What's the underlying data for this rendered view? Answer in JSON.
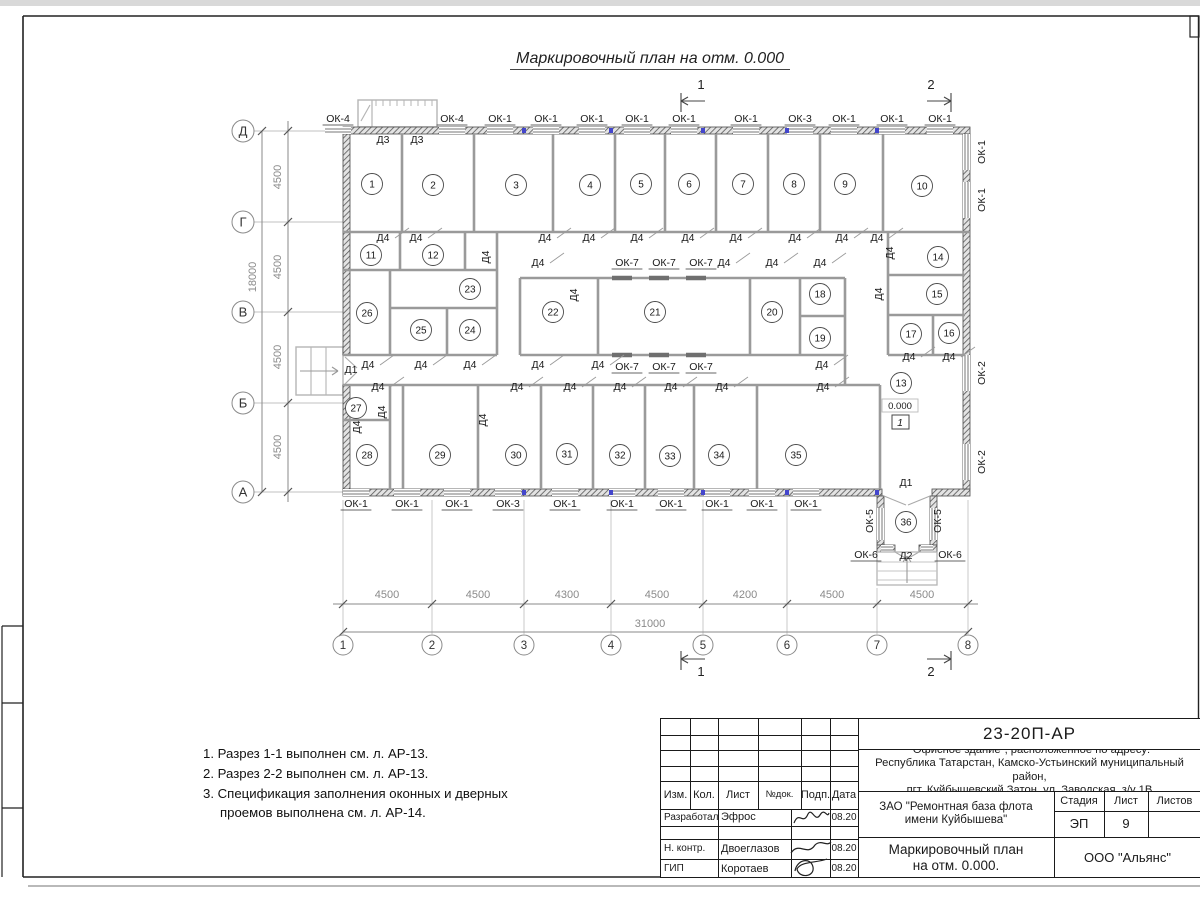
{
  "sheet": {
    "plan_title": "Маркировочный план на отм. 0.000"
  },
  "notes": {
    "items": [
      "1. Разрез 1-1 выполнен см. л. АР-13.",
      "2. Разрез 2-2 выполнен см. л. АР-13.",
      "3. Спецификация заполнения оконных и дверных проемов выполнена см. л. АР-14."
    ]
  },
  "plan": {
    "axis_cols": [
      {
        "label": "1",
        "x": 343
      },
      {
        "label": "2",
        "x": 432
      },
      {
        "label": "3",
        "x": 524
      },
      {
        "label": "4",
        "x": 611
      },
      {
        "label": "5",
        "x": 703
      },
      {
        "label": "6",
        "x": 787
      },
      {
        "label": "7",
        "x": 877
      },
      {
        "label": "8",
        "x": 968
      }
    ],
    "axis_rows": [
      {
        "label": "Д",
        "y": 131
      },
      {
        "label": "Г",
        "y": 222
      },
      {
        "label": "В",
        "y": 312
      },
      {
        "label": "Б",
        "y": 403
      },
      {
        "label": "А",
        "y": 492
      }
    ],
    "dims_bottom": {
      "segments": [
        {
          "text": "4500",
          "x": 387
        },
        {
          "text": "4500",
          "x": 478
        },
        {
          "text": "4300",
          "x": 567
        },
        {
          "text": "4500",
          "x": 657
        },
        {
          "text": "4200",
          "x": 745
        },
        {
          "text": "4500",
          "x": 832
        },
        {
          "text": "4500",
          "x": 922
        }
      ],
      "total": {
        "text": "31000",
        "x": 650
      }
    },
    "dims_left": {
      "segments": [
        {
          "text": "4500",
          "y": 177
        },
        {
          "text": "4500",
          "y": 267
        },
        {
          "text": "4500",
          "y": 357
        },
        {
          "text": "4500",
          "y": 447
        }
      ],
      "total": {
        "text": "18000",
        "y": 277
      }
    },
    "rooms": [
      {
        "n": "1",
        "x": 372,
        "y": 184
      },
      {
        "n": "2",
        "x": 433,
        "y": 185
      },
      {
        "n": "3",
        "x": 516,
        "y": 185
      },
      {
        "n": "4",
        "x": 590,
        "y": 185
      },
      {
        "n": "5",
        "x": 641,
        "y": 184
      },
      {
        "n": "6",
        "x": 689,
        "y": 184
      },
      {
        "n": "7",
        "x": 743,
        "y": 184
      },
      {
        "n": "8",
        "x": 794,
        "y": 184
      },
      {
        "n": "9",
        "x": 845,
        "y": 184
      },
      {
        "n": "10",
        "x": 922,
        "y": 186
      },
      {
        "n": "11",
        "x": 371,
        "y": 255
      },
      {
        "n": "12",
        "x": 433,
        "y": 255
      },
      {
        "n": "13",
        "x": 901,
        "y": 383
      },
      {
        "n": "14",
        "x": 938,
        "y": 257
      },
      {
        "n": "15",
        "x": 937,
        "y": 294
      },
      {
        "n": "16",
        "x": 949,
        "y": 333
      },
      {
        "n": "17",
        "x": 911,
        "y": 334
      },
      {
        "n": "18",
        "x": 820,
        "y": 294
      },
      {
        "n": "19",
        "x": 820,
        "y": 338
      },
      {
        "n": "20",
        "x": 772,
        "y": 312
      },
      {
        "n": "21",
        "x": 655,
        "y": 312
      },
      {
        "n": "22",
        "x": 553,
        "y": 312
      },
      {
        "n": "23",
        "x": 470,
        "y": 289
      },
      {
        "n": "24",
        "x": 470,
        "y": 330
      },
      {
        "n": "25",
        "x": 421,
        "y": 330
      },
      {
        "n": "26",
        "x": 367,
        "y": 313
      },
      {
        "n": "27",
        "x": 356,
        "y": 408
      },
      {
        "n": "28",
        "x": 367,
        "y": 455
      },
      {
        "n": "29",
        "x": 440,
        "y": 455
      },
      {
        "n": "30",
        "x": 516,
        "y": 455
      },
      {
        "n": "31",
        "x": 567,
        "y": 454
      },
      {
        "n": "32",
        "x": 620,
        "y": 455
      },
      {
        "n": "33",
        "x": 670,
        "y": 456
      },
      {
        "n": "34",
        "x": 719,
        "y": 455
      },
      {
        "n": "35",
        "x": 796,
        "y": 455
      },
      {
        "n": "36",
        "x": 906,
        "y": 522
      }
    ],
    "marks": [
      {
        "t": "ОК-4",
        "x": 338,
        "y": 122,
        "u": 1
      },
      {
        "t": "ОК-4",
        "x": 452,
        "y": 122,
        "u": 1
      },
      {
        "t": "ОК-1",
        "x": 500,
        "y": 122,
        "u": 1
      },
      {
        "t": "ОК-1",
        "x": 546,
        "y": 122,
        "u": 1
      },
      {
        "t": "ОК-1",
        "x": 592,
        "y": 122,
        "u": 1
      },
      {
        "t": "ОК-1",
        "x": 637,
        "y": 122,
        "u": 1
      },
      {
        "t": "ОК-1",
        "x": 684,
        "y": 122,
        "u": 1
      },
      {
        "t": "ОК-1",
        "x": 746,
        "y": 122,
        "u": 1
      },
      {
        "t": "ОК-3",
        "x": 800,
        "y": 122,
        "u": 1
      },
      {
        "t": "ОК-1",
        "x": 844,
        "y": 122,
        "u": 1
      },
      {
        "t": "ОК-1",
        "x": 892,
        "y": 122,
        "u": 1
      },
      {
        "t": "ОК-1",
        "x": 940,
        "y": 122,
        "u": 1
      },
      {
        "t": "Д3",
        "x": 383,
        "y": 143
      },
      {
        "t": "Д3",
        "x": 417,
        "y": 143
      },
      {
        "t": "Д4",
        "x": 383,
        "y": 241,
        "d": 1
      },
      {
        "t": "Д4",
        "x": 416,
        "y": 241,
        "d": 1
      },
      {
        "t": "Д4",
        "x": 545,
        "y": 241,
        "d": 1
      },
      {
        "t": "Д4",
        "x": 589,
        "y": 241,
        "d": 1
      },
      {
        "t": "Д4",
        "x": 637,
        "y": 241,
        "d": 1
      },
      {
        "t": "Д4",
        "x": 688,
        "y": 241,
        "d": 1
      },
      {
        "t": "Д4",
        "x": 736,
        "y": 241,
        "d": 1
      },
      {
        "t": "Д4",
        "x": 795,
        "y": 241,
        "d": 1
      },
      {
        "t": "Д4",
        "x": 842,
        "y": 241,
        "d": 1
      },
      {
        "t": "Д4",
        "x": 877,
        "y": 241,
        "d": 1
      },
      {
        "t": "Д4",
        "x": 489,
        "y": 257,
        "r": 1
      },
      {
        "t": "Д4",
        "x": 577,
        "y": 295,
        "r": 1
      },
      {
        "t": "Д4",
        "x": 893,
        "y": 253,
        "r": 1
      },
      {
        "t": "Д4",
        "x": 882,
        "y": 294,
        "r": 1
      },
      {
        "t": "Д4",
        "x": 538,
        "y": 266,
        "d": 1
      },
      {
        "t": "Д4",
        "x": 724,
        "y": 266,
        "d": 1
      },
      {
        "t": "Д4",
        "x": 772,
        "y": 266,
        "d": 1
      },
      {
        "t": "Д4",
        "x": 820,
        "y": 266,
        "d": 1
      },
      {
        "t": "ОК-7",
        "x": 627,
        "y": 266,
        "u": 1
      },
      {
        "t": "ОК-7",
        "x": 664,
        "y": 266,
        "u": 1
      },
      {
        "t": "ОК-7",
        "x": 701,
        "y": 266,
        "u": 1
      },
      {
        "t": "Д4",
        "x": 368,
        "y": 368,
        "d": 1
      },
      {
        "t": "Д4",
        "x": 421,
        "y": 368,
        "d": 1
      },
      {
        "t": "Д4",
        "x": 470,
        "y": 368,
        "d": 1
      },
      {
        "t": "Д4",
        "x": 538,
        "y": 368,
        "d": 1
      },
      {
        "t": "Д4",
        "x": 598,
        "y": 368,
        "d": 1
      },
      {
        "t": "Д4",
        "x": 822,
        "y": 368,
        "d": 1
      },
      {
        "t": "ОК-7",
        "x": 627,
        "y": 370,
        "u": 1
      },
      {
        "t": "ОК-7",
        "x": 664,
        "y": 370,
        "u": 1
      },
      {
        "t": "ОК-7",
        "x": 701,
        "y": 370,
        "u": 1
      },
      {
        "t": "Д4",
        "x": 909,
        "y": 360,
        "d": 1
      },
      {
        "t": "Д4",
        "x": 949,
        "y": 360,
        "d": 1
      },
      {
        "t": "Д4",
        "x": 378,
        "y": 390,
        "d": 1
      },
      {
        "t": "Д4",
        "x": 517,
        "y": 390,
        "d": 1
      },
      {
        "t": "Д4",
        "x": 570,
        "y": 390,
        "d": 1
      },
      {
        "t": "Д4",
        "x": 620,
        "y": 390,
        "d": 1
      },
      {
        "t": "Д4",
        "x": 671,
        "y": 390,
        "d": 1
      },
      {
        "t": "Д4",
        "x": 722,
        "y": 390,
        "d": 1
      },
      {
        "t": "Д4",
        "x": 823,
        "y": 390,
        "d": 1
      },
      {
        "t": "Д4",
        "x": 360,
        "y": 427,
        "r": 1
      },
      {
        "t": "Д4",
        "x": 385,
        "y": 412,
        "r": 1
      },
      {
        "t": "Д4",
        "x": 486,
        "y": 420,
        "r": 1
      },
      {
        "t": "Д1",
        "x": 351,
        "y": 373
      },
      {
        "t": "ОК-1",
        "x": 356,
        "y": 507,
        "u": 1
      },
      {
        "t": "ОК-1",
        "x": 407,
        "y": 507,
        "u": 1
      },
      {
        "t": "ОК-1",
        "x": 457,
        "y": 507,
        "u": 1
      },
      {
        "t": "ОК-3",
        "x": 508,
        "y": 507,
        "u": 1
      },
      {
        "t": "ОК-1",
        "x": 565,
        "y": 507,
        "u": 1
      },
      {
        "t": "ОК-1",
        "x": 622,
        "y": 507,
        "u": 1
      },
      {
        "t": "ОК-1",
        "x": 671,
        "y": 507,
        "u": 1
      },
      {
        "t": "ОК-1",
        "x": 717,
        "y": 507,
        "u": 1
      },
      {
        "t": "ОК-1",
        "x": 762,
        "y": 507,
        "u": 1
      },
      {
        "t": "ОК-1",
        "x": 806,
        "y": 507,
        "u": 1
      },
      {
        "t": "ОК-1",
        "x": 985,
        "y": 152,
        "r": 1
      },
      {
        "t": "ОК-1",
        "x": 985,
        "y": 200,
        "r": 1
      },
      {
        "t": "ОК-2",
        "x": 985,
        "y": 373,
        "r": 1
      },
      {
        "t": "ОК-2",
        "x": 985,
        "y": 462,
        "r": 1
      },
      {
        "t": "Д1",
        "x": 906,
        "y": 486
      },
      {
        "t": "ОК-5",
        "x": 873,
        "y": 521,
        "r": 1
      },
      {
        "t": "ОК-5",
        "x": 941,
        "y": 521,
        "r": 1
      },
      {
        "t": "Д2",
        "x": 906,
        "y": 559
      },
      {
        "t": "ОК-6",
        "x": 866,
        "y": 558,
        "u": 1
      },
      {
        "t": "ОК-6",
        "x": 950,
        "y": 558,
        "u": 1
      }
    ],
    "level_mark": {
      "elevation": "0.000",
      "floor": "1"
    },
    "section_marks": {
      "s1": "1",
      "s2": "2"
    }
  },
  "titleblock": {
    "doc_number": "23-20П-АР",
    "address_lines": [
      "\"Офисное здание\", расположенное по адресу:",
      "Республика Татарстан, Камско-Устьинский муниципальный район,",
      "пгт. Куйбышевский Затон, ул. Заводская, з/у 1В"
    ],
    "rev_header": {
      "izm": "Изм.",
      "kol": "Кол.",
      "list": "Лист",
      "ndok": "№док.",
      "podp": "Подп.",
      "data": "Дата"
    },
    "signers": [
      {
        "role": "Разработал",
        "name": "Эфрос",
        "date": "08.20"
      },
      {
        "role": "Н. контр.",
        "name": "Двоеглазов",
        "date": "08.20"
      },
      {
        "role": "ГИП",
        "name": "Коротаев",
        "date": "08.20"
      }
    ],
    "client": [
      "ЗАО \"Ремонтная база флота",
      "имени Куйбышева\""
    ],
    "stage_header": {
      "stage": "Стадия",
      "sheet": "Лист",
      "sheets": "Листов"
    },
    "stage_value": "ЭП",
    "sheet_value": "9",
    "sheets_value": "",
    "drawing_title": [
      "Маркировочный план",
      "на отм. 0.000."
    ],
    "company": "ООО \"Альянс\""
  }
}
